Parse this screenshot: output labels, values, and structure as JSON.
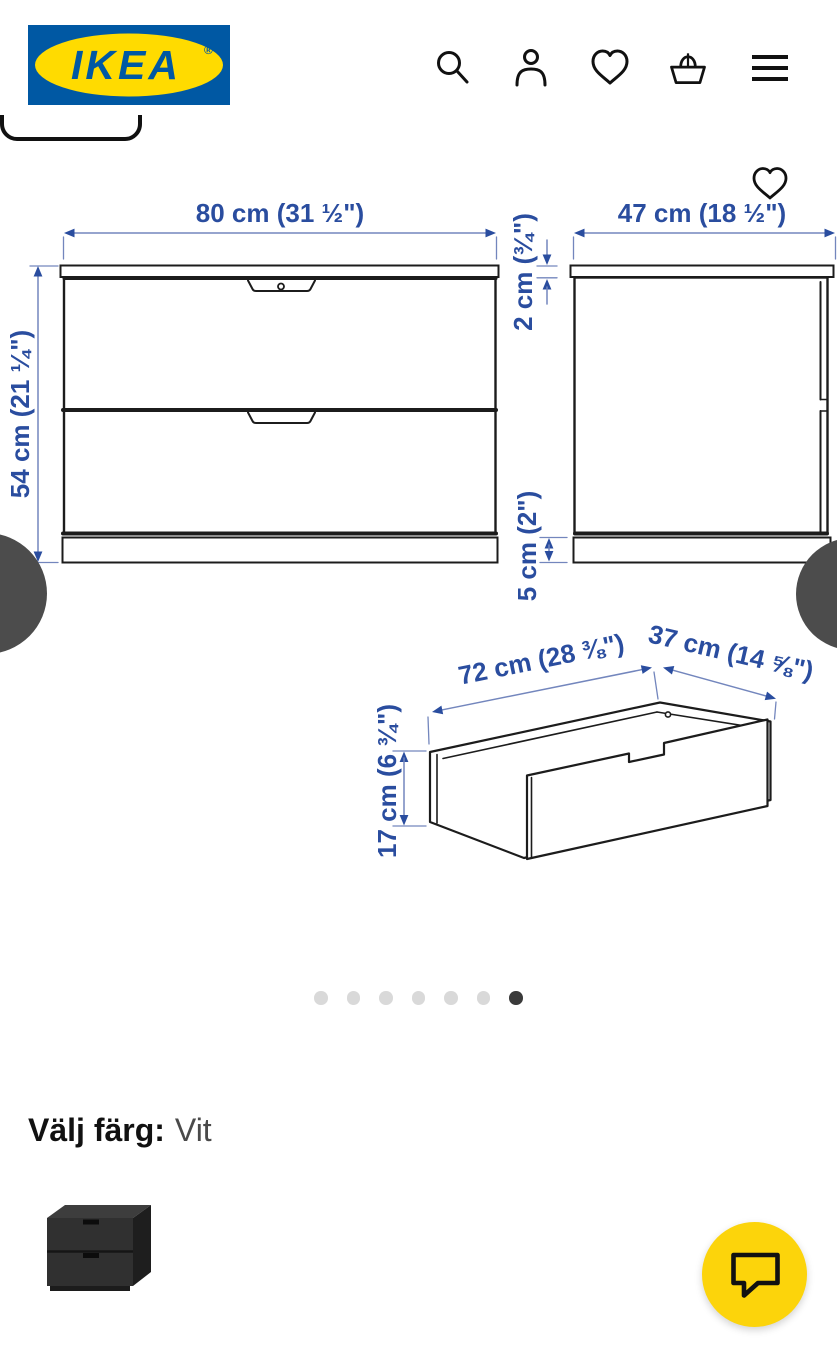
{
  "header": {
    "logo": {
      "text": "IKEA",
      "mark": "®",
      "bg_color": "#0058A3",
      "ellipse_color": "#FFDB00"
    },
    "icons": {
      "search": "magnifier",
      "profile": "person",
      "favorites": "heart",
      "cart": "basket",
      "menu": "hamburger"
    }
  },
  "gallery": {
    "favorite_icon": "heart-outline",
    "dimensions": {
      "front_width": "80 cm (31 ½\")",
      "front_height": "54 cm (21 ¼\")",
      "side_depth": "47 cm (18 ½\")",
      "top_thickness": "2 cm (¾\")",
      "plinth_height": "5 cm (2\")",
      "drawer_width": "72 cm (28 ⅜\")",
      "drawer_depth": "37 cm (14 ⅝\")",
      "drawer_height": "17 cm (6 ¾\")"
    },
    "annotation_text_color": "#2a4d9f",
    "annotation_line_color": "#7386bd",
    "drawing_line_color": "#1c1c1c",
    "dots": {
      "count": 7,
      "active_index": 6
    }
  },
  "color_picker": {
    "label": "Välj färg:",
    "selected_value": "Vit",
    "options": [
      {
        "id": "anthracite",
        "selected": false
      },
      {
        "id": "white",
        "selected": true
      }
    ]
  },
  "chat": {
    "button_color": "#FCD40B",
    "icon": "speech-bubble"
  }
}
